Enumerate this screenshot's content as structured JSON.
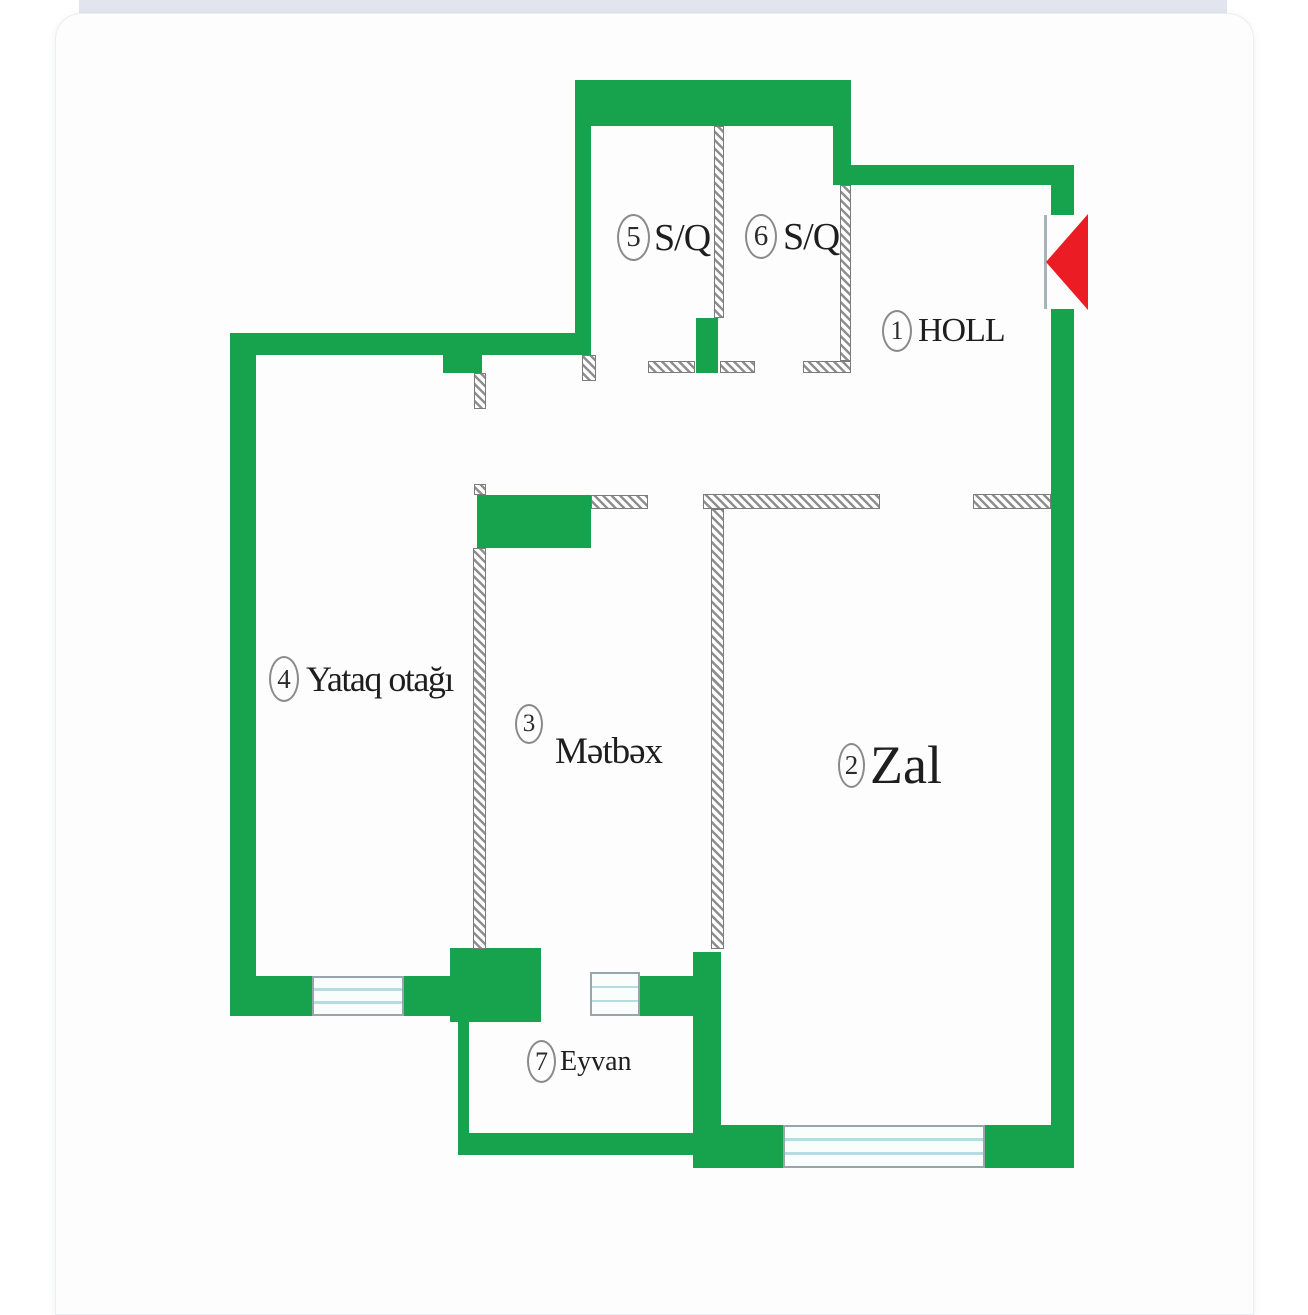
{
  "plan": {
    "title_hint": "apartment floor plan",
    "colors": {
      "wall_green": "#17a24d",
      "entrance_arrow_red": "#ec1c24",
      "hatch_gray": "#8f8f8f",
      "window_line_blue": "#b7dbe2",
      "top_bar": "#e2e4ee",
      "card_background": "#fdfdfe"
    },
    "rooms": [
      {
        "number": "1",
        "name": "HOLL"
      },
      {
        "number": "2",
        "name": "Zal"
      },
      {
        "number": "3",
        "name": "Mətbəx"
      },
      {
        "number": "4",
        "name": "Yataq otağı"
      },
      {
        "number": "5",
        "name": "S/Q"
      },
      {
        "number": "6",
        "name": "S/Q"
      },
      {
        "number": "7",
        "name": "Eyvan"
      }
    ]
  }
}
